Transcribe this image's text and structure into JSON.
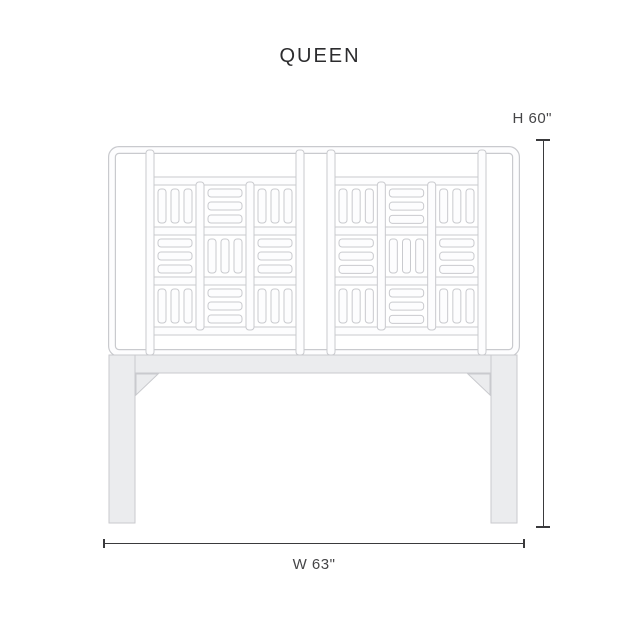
{
  "title": "QUEEN",
  "dimensions": {
    "height_label": "H 60\"",
    "width_label": "W 63\""
  },
  "diagram": {
    "type": "furniture-dimension-diagram",
    "subject": "fretwork-headboard",
    "panels": 2,
    "fretwork_pattern": [
      "VHV",
      "HVH",
      "VHV"
    ],
    "bars_per_block": 3,
    "colors": {
      "background": "#ffffff",
      "outline": "#c9cace",
      "tube_fill": "#fdfdfe",
      "solid_fill": "#ebecee",
      "dimension_line": "#3a3a3c",
      "label_text": "#454547",
      "title_text": "#2c2c2e"
    }
  }
}
